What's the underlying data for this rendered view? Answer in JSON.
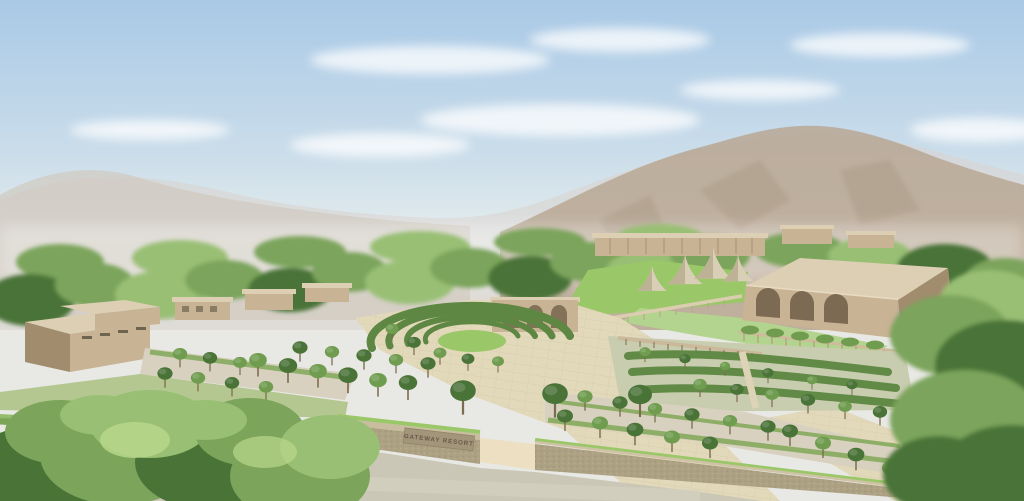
{
  "scene": {
    "description": "Aerial architectural rendering of a resort campus set against hazy mountains",
    "sign": {
      "text": "GATEWAY RESORT"
    },
    "features": [
      "sky with light clouds",
      "hazy mountain range",
      "wooded treeline",
      "resort cottages",
      "glamping tents",
      "event lawn",
      "grand hall with arched portico",
      "amphitheater terrace garden",
      "terraced hedge garden",
      "tree-lined parking courts",
      "paved entry plaza and driveways",
      "perimeter stone wall",
      "entrance gate with resort sign",
      "public road",
      "foreground trees"
    ],
    "colors": {
      "sky_top": "#a9c9e6",
      "sky_mid": "#c9dcea",
      "sky_horizon": "#eef2ee",
      "cloud_white": "#ffffff",
      "mountain_haze": "#d8d3d0",
      "mountain_left": "#cfc7bd",
      "mountain_right": "#b7a48e",
      "mountain_shadow": "#a08d77",
      "treeline_green": "#7ca45b",
      "treeline_light": "#99bf74",
      "tree_dark": "#4a7338",
      "tree_mid": "#6f9c4f",
      "lawn_bright": "#9ac768",
      "lawn_light": "#b2d48e",
      "building_roof": "#ddcfb4",
      "building_wall": "#c8b394",
      "building_shadow": "#a18c6d",
      "arch_dark": "#7c6b52",
      "paving": "#e2d8ba",
      "paving_light": "#ecdfc2",
      "gravel": "#d8d1bf",
      "road": "#cbc7b6",
      "wall_stone": "#ada184",
      "wall_shadow": "#948969",
      "hedge_green": "#5d8742",
      "sign_text": "#66594a"
    }
  }
}
